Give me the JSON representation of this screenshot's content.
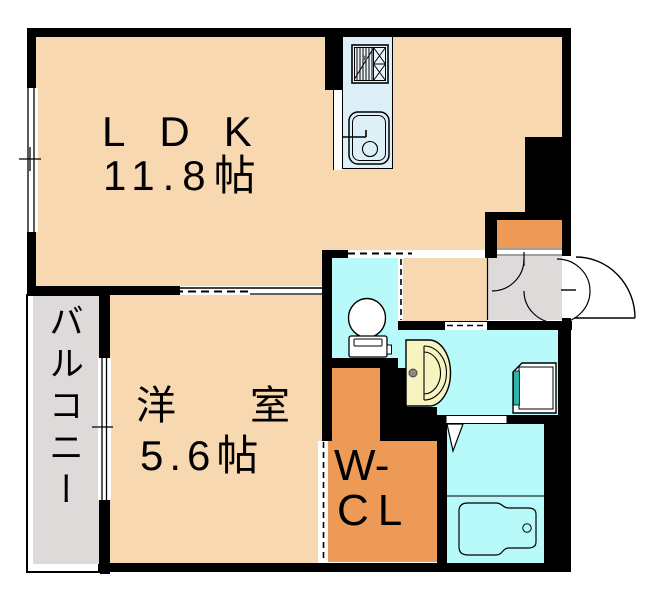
{
  "title": "apartment-floor-plan",
  "rooms": {
    "ldk": {
      "name": "LDK",
      "size": "11.8帖"
    },
    "western_room": {
      "name": "洋室",
      "size": "5.6帖"
    },
    "walk_in_closet": {
      "line1": "W-",
      "line2": "CL"
    },
    "balcony": {
      "name": "バルコニー"
    }
  },
  "fixtures": [
    "gas-stove",
    "kitchen-sink",
    "toilet",
    "vanity-basin",
    "washing-machine-pan",
    "bathtub",
    "entrance-door",
    "shoe-cabinet"
  ],
  "colors": {
    "room_peach": "#F8D8B0",
    "closet_orange": "#EC9A55",
    "wet_cyan": "#B8F9F9",
    "entry_gray": "#DEDADA",
    "counter_blue": "#DDF0F8",
    "vanity_yellow": "#F8F4C2",
    "laundry_teal": "#2FB4AC",
    "wall_black": "#000000"
  }
}
